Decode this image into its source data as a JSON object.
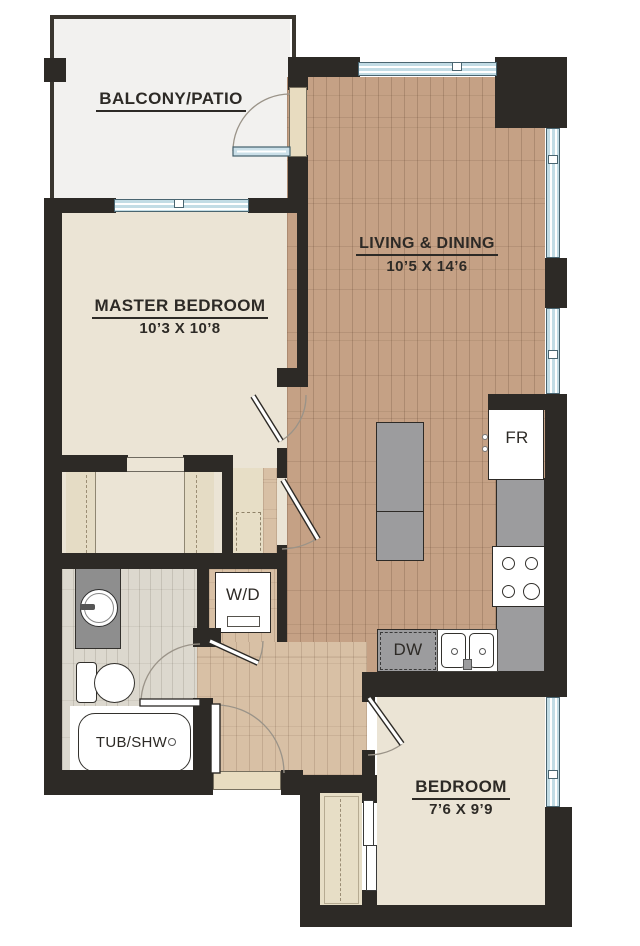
{
  "plan_type": "apartment-floor-plan",
  "rooms": {
    "balcony": {
      "label": "BALCONY/PATIO"
    },
    "living": {
      "label": "LIVING & DINING",
      "dims": "10’5 X 14’6"
    },
    "master": {
      "label": "MASTER BEDROOM",
      "dims": "10’3 X 10’8"
    },
    "bedroom": {
      "label": "BEDROOM",
      "dims": "7’6 X 9’9"
    }
  },
  "fixtures": {
    "washer_dryer": "W/D",
    "refrigerator": "FR",
    "dishwasher": "DW",
    "tub_shower": "TUB/SHW"
  },
  "colors": {
    "wall": "#2d2a26",
    "living_wood_floor": "#c5a185",
    "hall_wood_floor": "#d8c0a5",
    "bedroom_floor": "#ebe4d5",
    "bath_tile_floor": "#dcd8ce",
    "closet_floor": "#e7dec6",
    "balcony_floor": "#f2f1ef",
    "window_glass": "#c2dce5",
    "counter_gray": "#9c9c9e",
    "door_jamb_tan": "#e8dcc0"
  }
}
